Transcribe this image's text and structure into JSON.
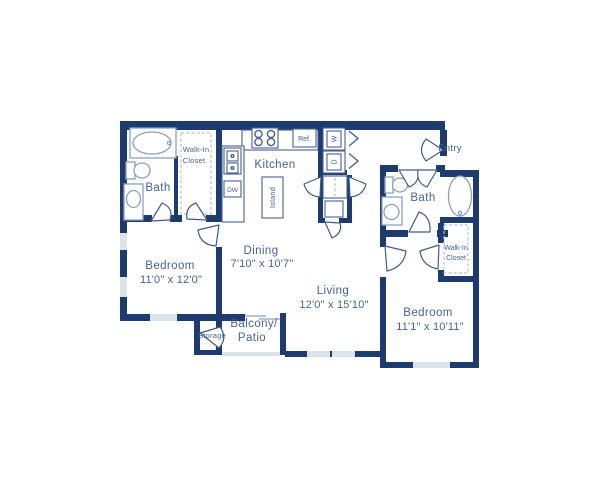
{
  "palette": {
    "wall": "#1e3b6d",
    "fixture_line": "#8aa0bf",
    "counter_line": "#46628f",
    "text": "#476392",
    "window": "#dde3ea",
    "dashed": "#b3c0d4",
    "background": "#ffffff"
  },
  "rooms": {
    "kitchen": {
      "label": "Kitchen"
    },
    "dining": {
      "label": "Dining",
      "dimensions": "7'10\" x 10'7\""
    },
    "living": {
      "label": "Living",
      "dimensions": "12'0\" x 15'10\""
    },
    "bedroom1": {
      "label": "Bedroom",
      "dimensions": "11'0\" x 12'0\""
    },
    "bedroom2": {
      "label": "Bedroom",
      "dimensions": "11'1\" x 10'11\""
    },
    "bath1": {
      "label": "Bath"
    },
    "bath2": {
      "label": "Bath"
    },
    "walk_in_closet1": {
      "line1": "Walk-In",
      "line2": "Closet"
    },
    "walk_in_closet2": {
      "line1": "Walk-In",
      "line2": "Closet"
    },
    "balcony": {
      "line1": "Balcony/",
      "line2": "Patio"
    },
    "storage": {
      "label": "Storage"
    },
    "entry": {
      "label": "Entry"
    },
    "island": {
      "label": "Island"
    }
  },
  "appliances": {
    "refrigerator": "Ref.",
    "dishwasher": "DW",
    "washer": "W",
    "dryer": "D"
  }
}
